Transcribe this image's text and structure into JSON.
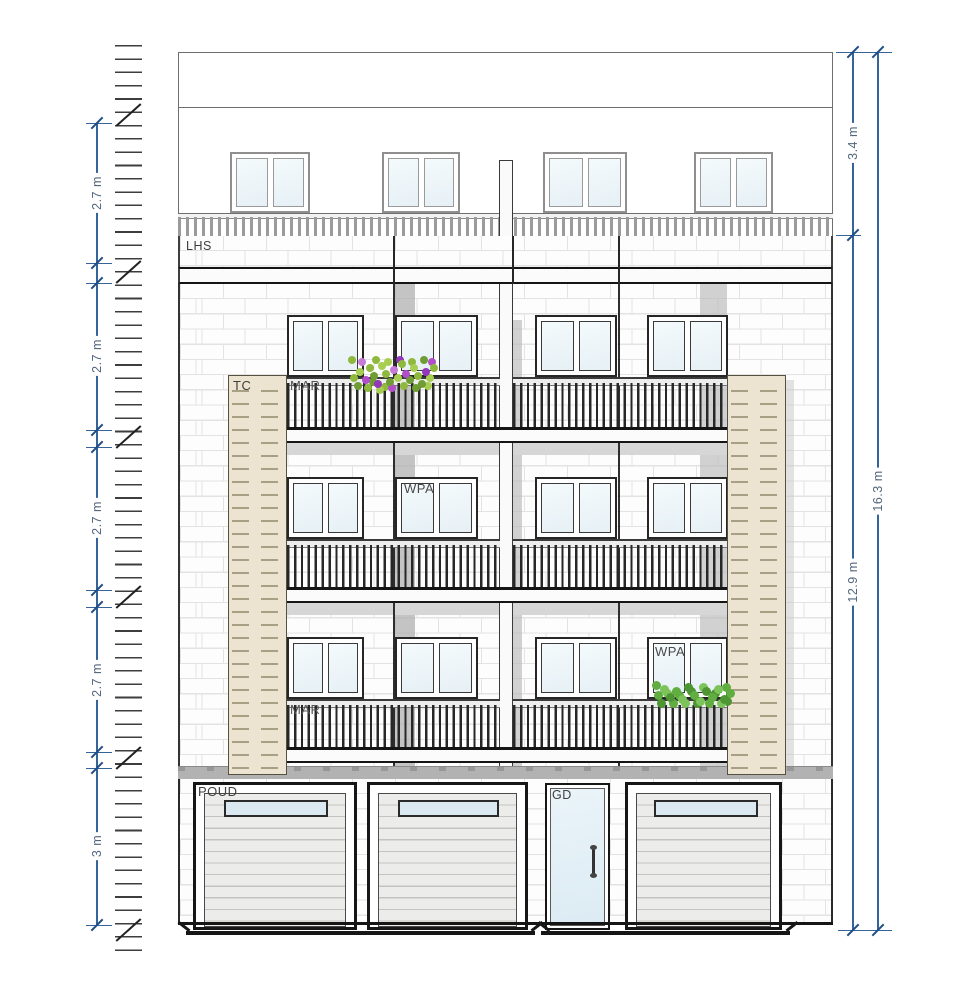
{
  "drawing": {
    "title": "building front elevation",
    "labels": {
      "lhs": "LHS",
      "tc": "TC",
      "mar_upper": "MAR",
      "mar_lower": "MAR",
      "wpa_mid": "WPA",
      "wpa_lower": "WPA",
      "poud": "POUD",
      "gd": "GD"
    },
    "dimensions": {
      "left": [
        {
          "label": "2.7 m"
        },
        {
          "label": "2.7 m"
        },
        {
          "label": "2.7 m"
        },
        {
          "label": "2.7 m"
        },
        {
          "label": "3 m"
        }
      ],
      "right": [
        {
          "label": "3.4 m"
        },
        {
          "label": "12.9 m"
        },
        {
          "label": "16.3 m"
        }
      ]
    },
    "colors": {
      "dimension_line": "#35639a",
      "dimension_text": "#53677d",
      "linework": "#2a2a2a",
      "pier_tan": "#ece4d1",
      "glass_blue": "#e6f0f5",
      "shadow_gray": "#c5c5c5"
    }
  }
}
